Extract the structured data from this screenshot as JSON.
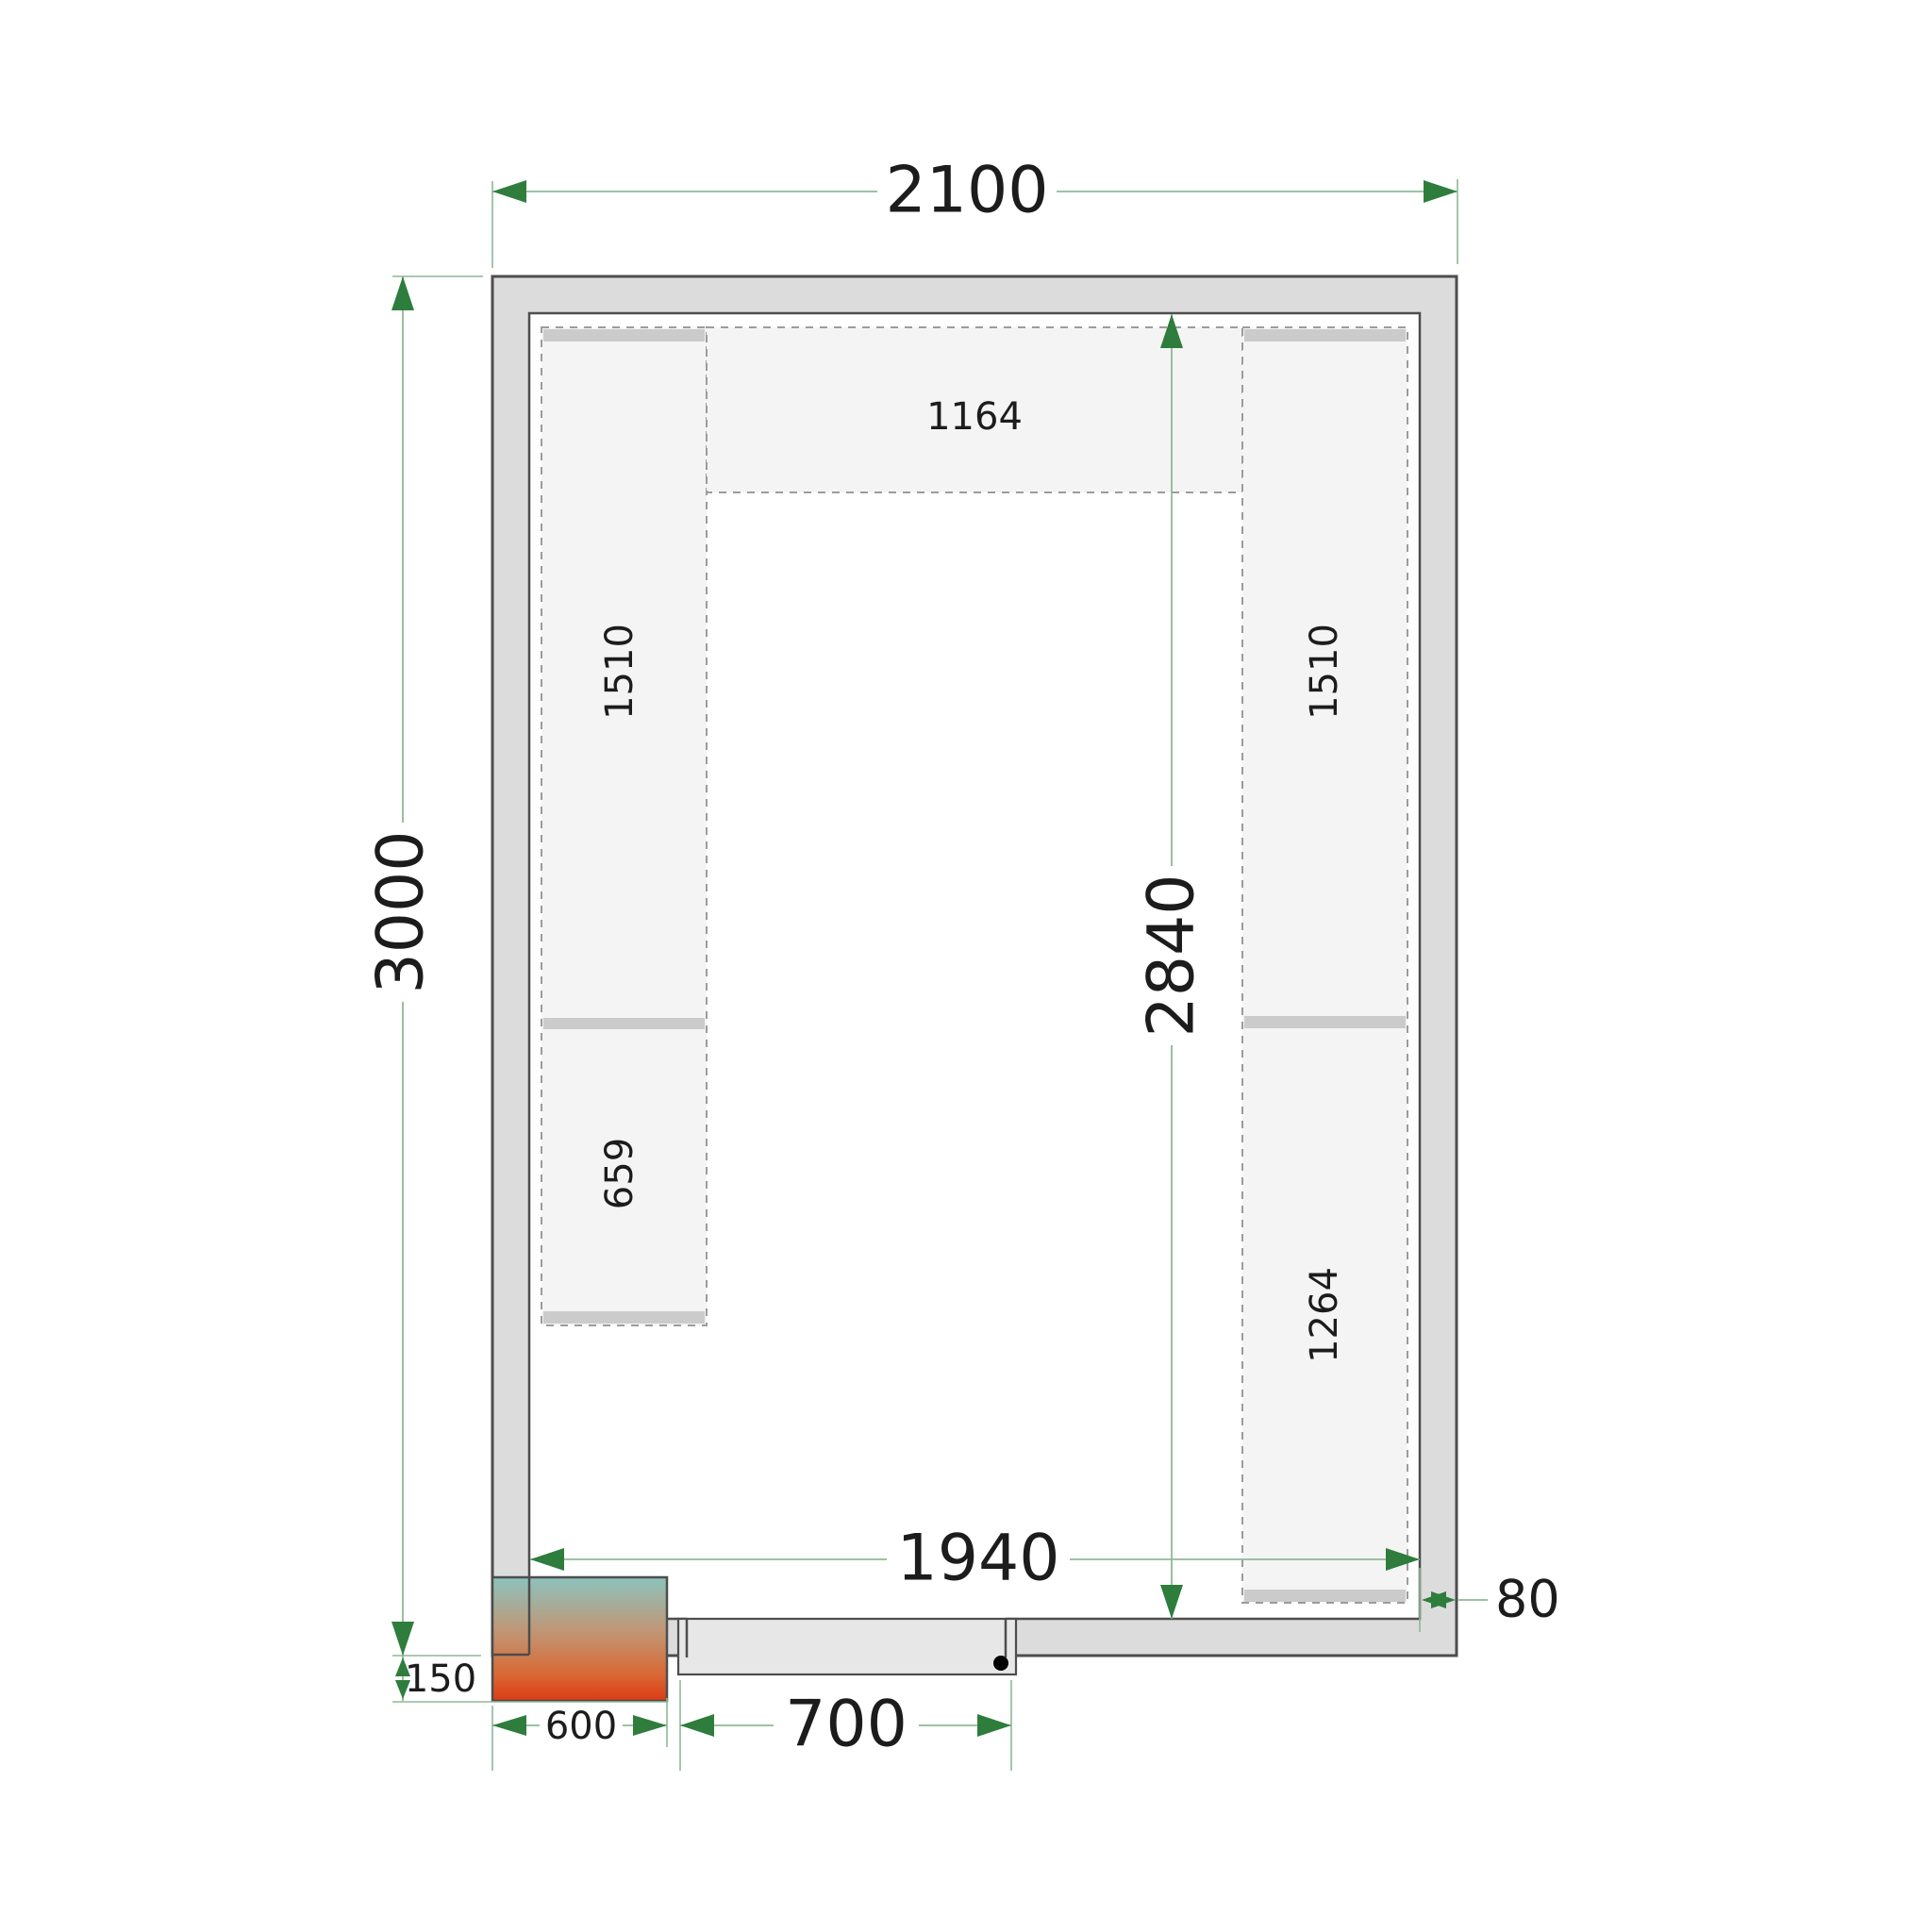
{
  "diagram": {
    "kind": "cold-room-floor-plan-top-view",
    "dims": {
      "outer_width": "2100",
      "outer_height": "3000",
      "inner_height": "2840",
      "inner_width": "1940",
      "door_width": "700",
      "unit_width": "600",
      "unit_protrusion": "150",
      "wall_thickness": "80"
    },
    "shelves": {
      "top_center": "1164",
      "left_upper": "1510",
      "left_lower": "659",
      "right_upper": "1510",
      "right_lower": "1264"
    },
    "colors": {
      "wall_fill": "#dcdcdc",
      "wall_stroke": "#4d4d4d",
      "shelf_fill": "#f4f4f4",
      "shelf_dash": "#9c9c9c",
      "shelf_band": "#cbcbcb",
      "dim_line": "#8db996",
      "dim_arrow": "#2e7d3c",
      "label_text": "#1c1c1c",
      "unit_gradient_top": "#8CC3BD",
      "unit_gradient_mid": "#BE9878",
      "unit_gradient_low": "#D96A36",
      "unit_gradient_bottom": "#DC3A14",
      "door_fill": "#e7e7e7",
      "hinge_dot": "#000000"
    }
  }
}
